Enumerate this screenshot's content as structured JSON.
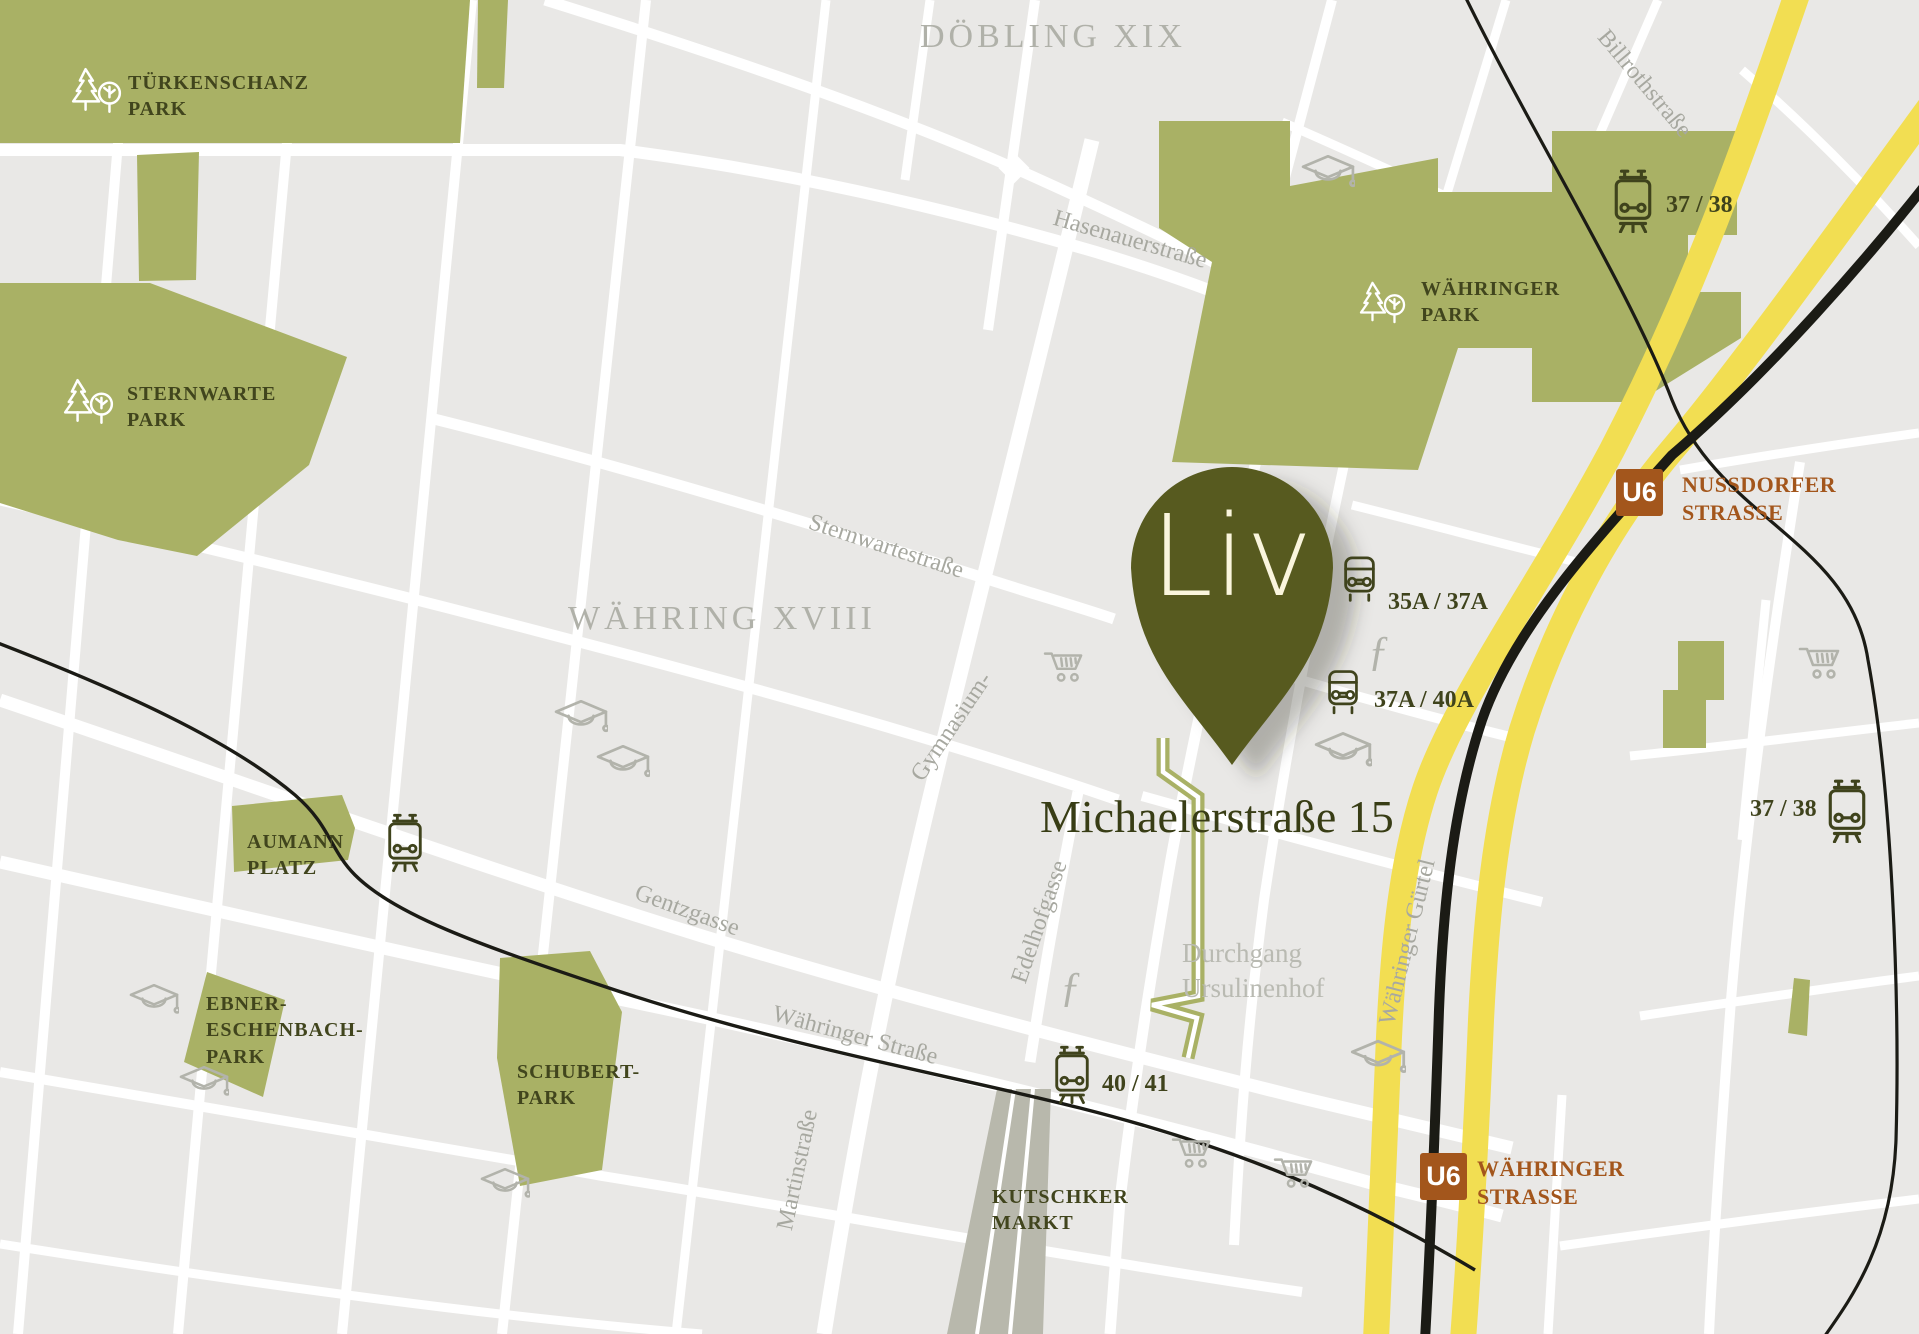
{
  "pin": {
    "label": "Liv",
    "address": "Michaelerstraße 15"
  },
  "districts": {
    "doebling": "DÖBLING XIX",
    "waehring": "WÄHRING XVIII"
  },
  "parks": {
    "tuerkenschanz": "TÜRKENSCHANZ\nPARK",
    "sternwarte": "STERNWARTE\nPARK",
    "waehringer": "WÄHRINGER\nPARK",
    "aumann": "AUMANN\nPLATZ",
    "ebner": "EBNER-\nESCHENBACH-\nPARK",
    "schubert": "SCHUBERT-\nPARK",
    "kutschker": "KUTSCHKER\nMARKT"
  },
  "streets": {
    "hasenauer": "Hasenauerstraße",
    "billroth": "Billrothstraße",
    "sternwartestrasse": "Sternwartestraße",
    "gymnasium": "Gymnasium-",
    "gentzgasse": "Gentzgasse",
    "waehringer_strasse": "Währinger Straße",
    "edelhofgasse": "Edelhofgasse",
    "martinstrasse": "Martinstraße",
    "guertel": "Währinger Gürtel",
    "durchgang": "Durchgang\nUrsulinenhof"
  },
  "transit": {
    "tram_37_38_north": "37 / 38",
    "tram_37_38_east": "37 / 38",
    "bus_35a_37a": "35A / 37A",
    "bus_37a_40a": "37A / 40A",
    "tram_40_41": "40 / 41",
    "u6_badge": "U6",
    "u6_nussdorfer": "NUSSDORFER\nSTRASSE",
    "u6_waehringer": "WÄHRINGER\nSTRASSE"
  },
  "colors": {
    "park_green": "#a9b165",
    "pin_olive": "#575a1f",
    "label_olive": "#3f431c",
    "u6_brown": "#a3561c",
    "guertel_yellow": "#f2de52",
    "rail_black": "#1b1b15",
    "block_gray": "#e9e8e6",
    "market_gray": "#b8b8ac",
    "muted_gray": "#a7a8a0"
  }
}
